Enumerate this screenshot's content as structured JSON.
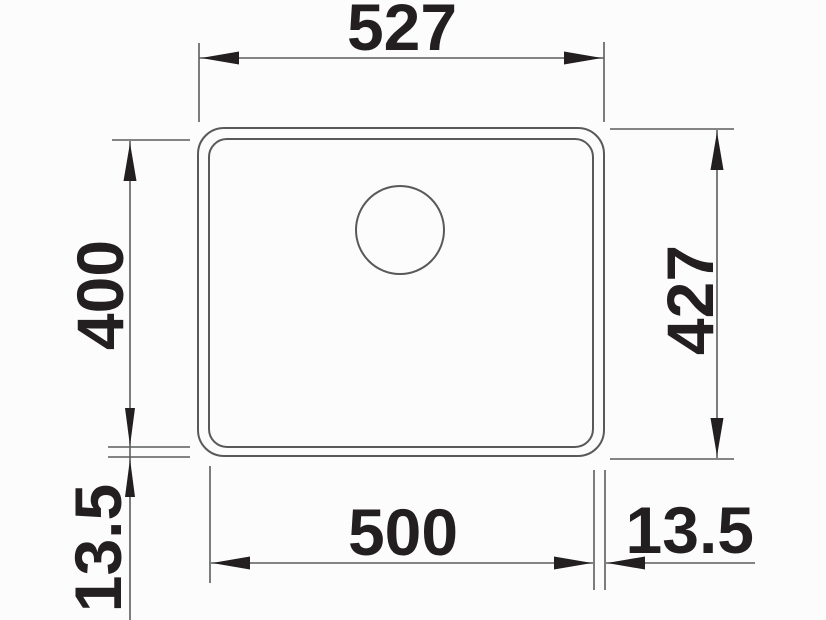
{
  "drawing": {
    "type": "technical-dimension-drawing",
    "subject": "sink-top-view",
    "units": "mm",
    "labels": {
      "outer_width": "527",
      "inner_depth": "400",
      "outer_depth": "427",
      "inner_width": "500",
      "rim_bottom_left": "13.5",
      "rim_bottom_right": "13.5"
    },
    "colors": {
      "outline": "#58595b",
      "dimension_line": "#5b5c5e",
      "ink": "#231f20",
      "background": "#fcfcfc"
    }
  }
}
